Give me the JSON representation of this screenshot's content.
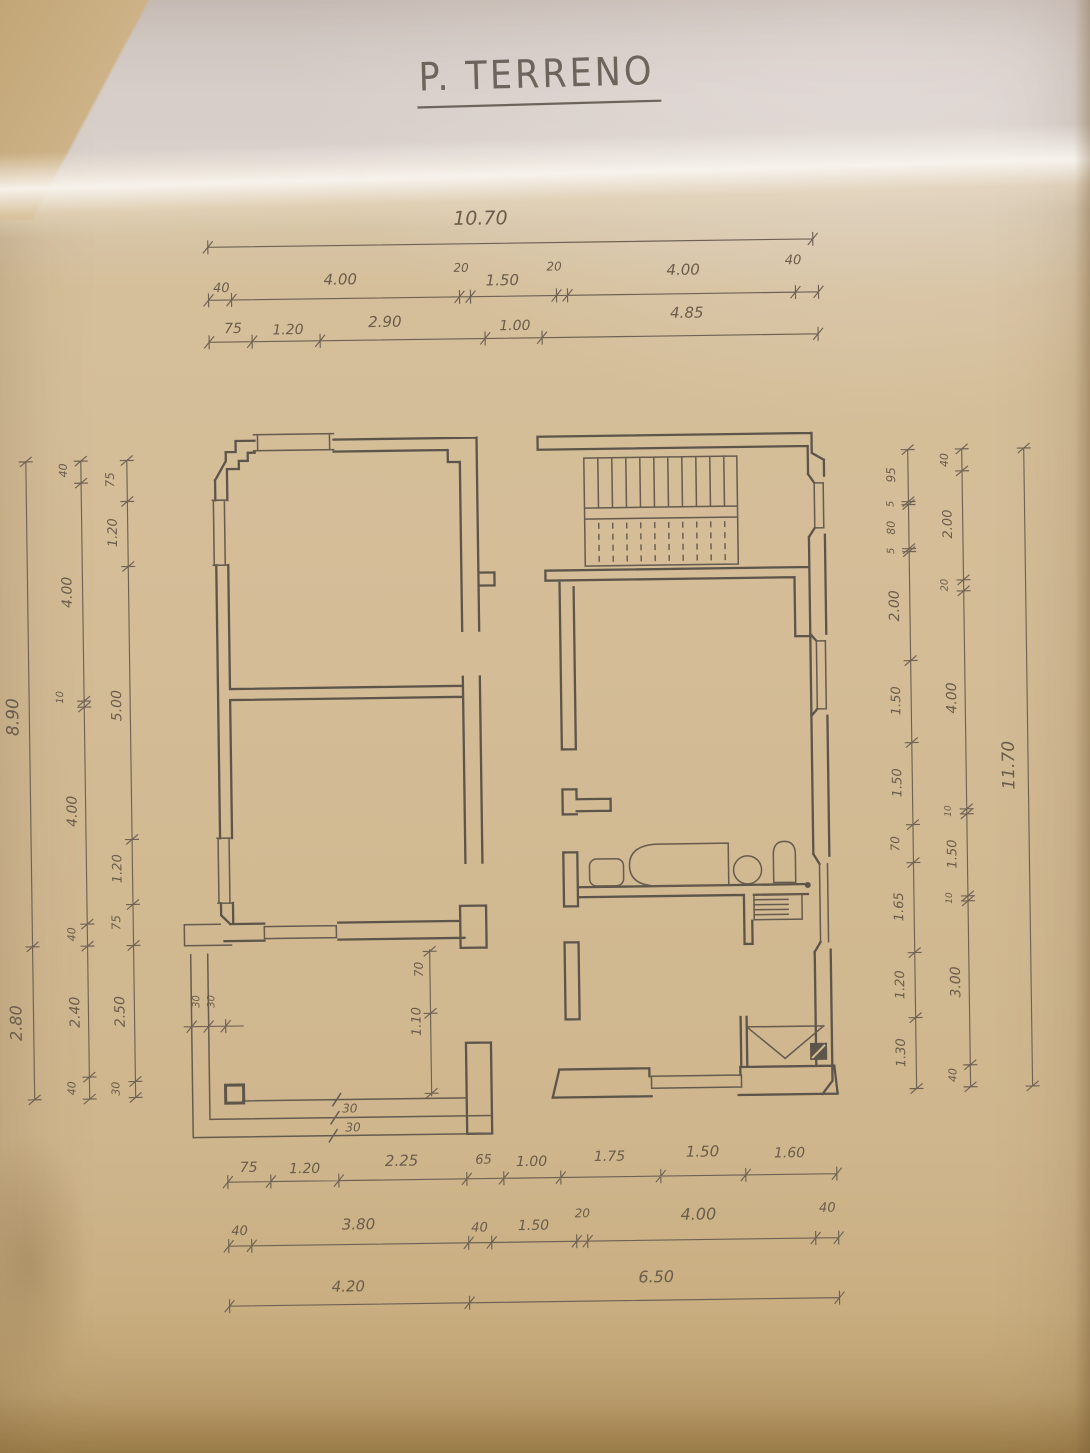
{
  "title": {
    "text": "P. TERRENO"
  },
  "colors": {
    "paper": "#d3bc96",
    "paper_dark": "#b99e73",
    "paper_band": "#d8cec9",
    "crease": "#f6f1e9",
    "ink": "#5d544a",
    "ink_thin": "#665b4e",
    "dim_line": "#6f6254",
    "text": "#6a5c4a"
  },
  "dimensions": {
    "groups": [
      {
        "name": "top-overall",
        "orient": "h",
        "line": [
          215,
          243,
          820,
          243
        ],
        "ticks": [
          215,
          820
        ],
        "labels": [
          {
            "t": "10.70",
            "x": 488,
            "y": 224,
            "s": 19
          }
        ]
      },
      {
        "name": "top-row-2",
        "orient": "h",
        "line": [
          215,
          296,
          825,
          296
        ],
        "ticks": [
          215,
          238,
          466,
          477,
          563,
          574,
          802,
          825
        ],
        "labels": [
          {
            "t": "40",
            "x": 228,
            "y": 288,
            "s": 13
          },
          {
            "t": "4.00",
            "x": 347,
            "y": 282,
            "s": 15
          },
          {
            "t": "20",
            "x": 468,
            "y": 271,
            "s": 12
          },
          {
            "t": "1.50",
            "x": 509,
            "y": 285,
            "s": 15
          },
          {
            "t": "20",
            "x": 561,
            "y": 271,
            "s": 12
          },
          {
            "t": "4.00",
            "x": 690,
            "y": 277,
            "s": 15
          },
          {
            "t": "40",
            "x": 800,
            "y": 268,
            "s": 13
          }
        ]
      },
      {
        "name": "top-row-3",
        "orient": "h",
        "line": [
          215,
          338,
          824,
          338
        ],
        "ticks": [
          215,
          258,
          326,
          491,
          548,
          824
        ],
        "labels": [
          {
            "t": "75",
            "x": 239,
            "y": 329,
            "s": 14
          },
          {
            "t": "1.20",
            "x": 294,
            "y": 331,
            "s": 14
          },
          {
            "t": "2.90",
            "x": 391,
            "y": 325,
            "s": 15
          },
          {
            "t": "1.00",
            "x": 521,
            "y": 330,
            "s": 14
          },
          {
            "t": "4.85",
            "x": 693,
            "y": 320,
            "s": 15
          }
        ]
      },
      {
        "name": "left-overall",
        "orient": "v",
        "line": [
          30,
          455,
          30,
          1093
        ],
        "ticks": [
          455,
          940,
          1093
        ],
        "labels": [
          {
            "t": "8.90",
            "x": 19,
            "y": 710,
            "s": 17
          },
          {
            "t": "2.80",
            "x": 18,
            "y": 1016,
            "s": 16
          }
        ]
      },
      {
        "name": "left-chain-axes",
        "orient": "v",
        "line": [
          85,
          455,
          85,
          1093
        ],
        "ticks": [
          455,
          477,
          695,
          701,
          918,
          940,
          1071,
          1093
        ],
        "labels": [
          {
            "t": "40",
            "x": 71,
            "y": 464,
            "s": 11
          },
          {
            "t": "4.00",
            "x": 74,
            "y": 586,
            "s": 14
          },
          {
            "t": "10",
            "x": 64,
            "y": 691,
            "s": 10
          },
          {
            "t": "4.00",
            "x": 76,
            "y": 805,
            "s": 14
          },
          {
            "t": "40",
            "x": 73,
            "y": 928,
            "s": 11
          },
          {
            "t": "2.40",
            "x": 76,
            "y": 1006,
            "s": 14
          },
          {
            "t": "40",
            "x": 71,
            "y": 1082,
            "s": 11
          }
        ]
      },
      {
        "name": "left-chain-detail",
        "orient": "v",
        "line": [
          131,
          455,
          131,
          1092
        ],
        "ticks": [
          455,
          496,
          561,
          834,
          899,
          940,
          1076,
          1092
        ],
        "labels": [
          {
            "t": "75",
            "x": 118,
            "y": 474,
            "s": 12
          },
          {
            "t": "1.20",
            "x": 120,
            "y": 527,
            "s": 13
          },
          {
            "t": "5.00",
            "x": 122,
            "y": 700,
            "s": 14
          },
          {
            "t": "1.20",
            "x": 120,
            "y": 863,
            "s": 13
          },
          {
            "t": "75",
            "x": 118,
            "y": 917,
            "s": 12
          },
          {
            "t": "2.50",
            "x": 121,
            "y": 1006,
            "s": 14
          },
          {
            "t": "30",
            "x": 115,
            "y": 1083,
            "s": 11
          }
        ]
      },
      {
        "name": "right-chain-detail",
        "orient": "v",
        "line": [
          912,
          455,
          912,
          1094
        ],
        "ticks": [
          455,
          507,
          510,
          554,
          557,
          666,
          748,
          830,
          868,
          958,
          1023,
          1094
        ],
        "labels": [
          {
            "t": "95",
            "x": 899,
            "y": 480,
            "s": 12
          },
          {
            "t": "5",
            "x": 897,
            "y": 509,
            "s": 10
          },
          {
            "t": "80",
            "x": 898,
            "y": 533,
            "s": 11
          },
          {
            "t": "5",
            "x": 897,
            "y": 556,
            "s": 10
          },
          {
            "t": "2.00",
            "x": 901,
            "y": 611,
            "s": 14
          },
          {
            "t": "1.50",
            "x": 901,
            "y": 706,
            "s": 13
          },
          {
            "t": "1.50",
            "x": 901,
            "y": 788,
            "s": 13
          },
          {
            "t": "70",
            "x": 898,
            "y": 849,
            "s": 12
          },
          {
            "t": "1.65",
            "x": 901,
            "y": 912,
            "s": 13
          },
          {
            "t": "1.20",
            "x": 901,
            "y": 990,
            "s": 13
          },
          {
            "t": "1.30",
            "x": 901,
            "y": 1058,
            "s": 13
          }
        ]
      },
      {
        "name": "right-chain-axes",
        "orient": "v",
        "line": [
          966,
          455,
          966,
          1093
        ],
        "ticks": [
          455,
          477,
          586,
          597,
          815,
          820,
          902,
          907,
          1071,
          1093
        ],
        "labels": [
          {
            "t": "40",
            "x": 952,
            "y": 466,
            "s": 11
          },
          {
            "t": "2.00",
            "x": 955,
            "y": 530,
            "s": 13
          },
          {
            "t": "20",
            "x": 950,
            "y": 591,
            "s": 10
          },
          {
            "t": "4.00",
            "x": 957,
            "y": 704,
            "s": 14
          },
          {
            "t": "10",
            "x": 950,
            "y": 817,
            "s": 9
          },
          {
            "t": "1.50",
            "x": 955,
            "y": 860,
            "s": 13
          },
          {
            "t": "10",
            "x": 950,
            "y": 904,
            "s": 9
          },
          {
            "t": "3.00",
            "x": 957,
            "y": 988,
            "s": 14
          },
          {
            "t": "40",
            "x": 952,
            "y": 1081,
            "s": 11
          }
        ]
      },
      {
        "name": "right-overall",
        "orient": "v",
        "line": [
          1028,
          455,
          1028,
          1093
        ],
        "ticks": [
          455,
          1093
        ],
        "labels": [
          {
            "t": "11.70",
            "x": 1014,
            "y": 772,
            "s": 17
          }
        ]
      },
      {
        "name": "bottom-row-1",
        "orient": "h",
        "line": [
          222,
          1178,
          831,
          1178
        ],
        "ticks": [
          222,
          265,
          333,
          461,
          498,
          555,
          655,
          740,
          831
        ],
        "labels": [
          {
            "t": "75",
            "x": 243,
            "y": 1168,
            "s": 14
          },
          {
            "t": "1.20",
            "x": 299,
            "y": 1170,
            "s": 14
          },
          {
            "t": "2.25",
            "x": 396,
            "y": 1164,
            "s": 15
          },
          {
            "t": "65",
            "x": 478,
            "y": 1163,
            "s": 13
          },
          {
            "t": "1.00",
            "x": 526,
            "y": 1166,
            "s": 14
          },
          {
            "t": "1.75",
            "x": 604,
            "y": 1162,
            "s": 14
          },
          {
            "t": "1.50",
            "x": 697,
            "y": 1159,
            "s": 15
          },
          {
            "t": "1.60",
            "x": 784,
            "y": 1161,
            "s": 14
          }
        ]
      },
      {
        "name": "bottom-row-2",
        "orient": "h",
        "line": [
          222,
          1242,
          832,
          1242
        ],
        "ticks": [
          222,
          245,
          462,
          485,
          570,
          581,
          809,
          832
        ],
        "labels": [
          {
            "t": "40",
            "x": 233,
            "y": 1231,
            "s": 13
          },
          {
            "t": "3.80",
            "x": 352,
            "y": 1227,
            "s": 15
          },
          {
            "t": "40",
            "x": 473,
            "y": 1231,
            "s": 13
          },
          {
            "t": "1.50",
            "x": 527,
            "y": 1230,
            "s": 14
          },
          {
            "t": "20",
            "x": 576,
            "y": 1218,
            "s": 12
          },
          {
            "t": "4.00",
            "x": 692,
            "y": 1222,
            "s": 16
          },
          {
            "t": "40",
            "x": 821,
            "y": 1216,
            "s": 13
          }
        ]
      },
      {
        "name": "bottom-row-3",
        "orient": "h",
        "line": [
          222,
          1302,
          832,
          1302
        ],
        "ticks": [
          222,
          462,
          832
        ],
        "labels": [
          {
            "t": "4.20",
            "x": 341,
            "y": 1289,
            "s": 15
          },
          {
            "t": "6.50",
            "x": 649,
            "y": 1284,
            "s": 16
          }
        ]
      },
      {
        "name": "terrace-left-steps",
        "orient": "h",
        "line": [
          180,
          1022,
          240,
          1022
        ],
        "ticks": [
          188,
          205,
          222
        ],
        "labels": [
          {
            "t": "30",
            "x": 196,
            "y": 997,
            "s": 10,
            "r": -90
          },
          {
            "t": "30",
            "x": 211,
            "y": 997,
            "s": 10,
            "r": -90
          }
        ]
      },
      {
        "name": "porch-depth",
        "orient": "v",
        "line": [
          427,
          948,
          427,
          1095
        ],
        "ticks": [
          950,
          1012,
          1092
        ],
        "labels": [
          {
            "t": "70",
            "x": 420,
            "y": 968,
            "s": 12
          },
          {
            "t": "1.10",
            "x": 417,
            "y": 1020,
            "s": 13
          }
        ]
      },
      {
        "name": "steps-depth",
        "orient": "h",
        "line": [
          345,
          1107,
          345,
          1107
        ],
        "ticks": [],
        "labels": [
          {
            "t": "30",
            "x": 345,
            "y": 1110,
            "s": 12,
            "r": 0
          },
          {
            "t": "30",
            "x": 348,
            "y": 1129,
            "s": 12,
            "r": 0
          }
        ]
      }
    ]
  }
}
